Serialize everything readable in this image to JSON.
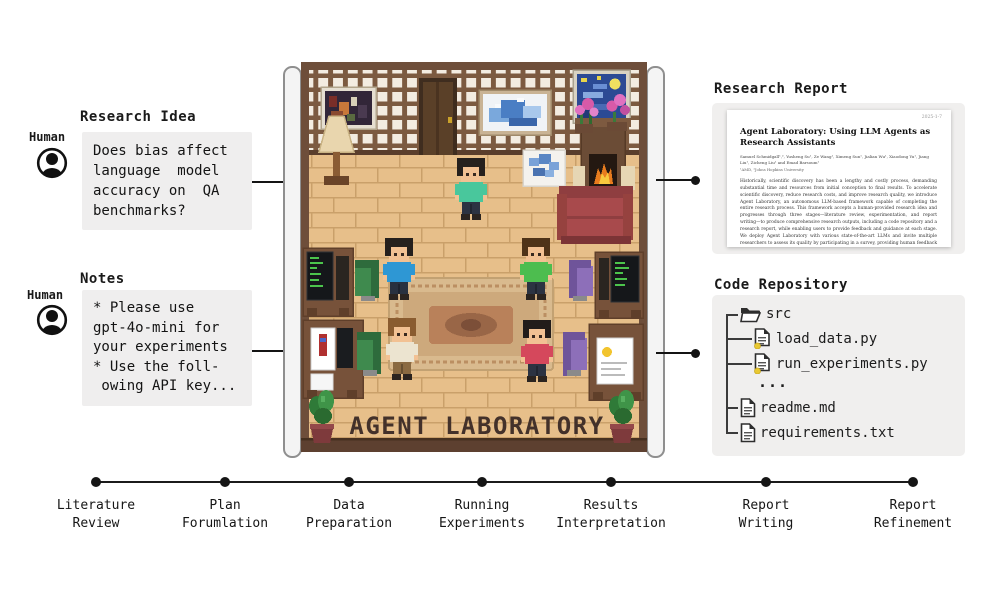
{
  "inputs": {
    "research_idea": {
      "heading": "Research Idea",
      "actor_label": "Human",
      "text": "Does bias affect\nlanguage  model\naccuracy on  QA\nbenchmarks?"
    },
    "notes": {
      "heading": "Notes",
      "actor_label": "Human",
      "text": "* Please use\ngpt-4o-mini for\nyour experiments\n* Use the foll-\n owing API key..."
    }
  },
  "lab": {
    "sign_text": "AGENT LABORATORY"
  },
  "outputs": {
    "research_report": {
      "heading": "Research Report",
      "paper": {
        "page_header": "2025-1-7",
        "title": "Agent Laboratory: Using LLM Agents as Research Assistants",
        "authors": "Samuel Schmidgall¹,², Yusheng Su¹, Ze Wang¹, Ximeng Sun¹, Jialian Wu¹, Xiaodong Yu¹, Jiang Liu¹, Zicheng Liu¹ and Emad Barsoum¹",
        "affiliation": "¹AMD, ²Johns Hopkins University",
        "abstract": "Historically, scientific discovery has been a lengthy and costly process, demanding substantial time and resources from initial conception to final results. To accelerate scientific discovery, reduce research costs, and improve research quality, we introduce Agent Laboratory, an autonomous LLM-based framework capable of completing the entire research process. This framework accepts a human-provided research idea and progresses through three stages—literature review, experimentation, and report writing—to produce comprehensive research outputs, including a code repository and a research report, while enabling users to provide feedback and guidance at each stage. We deploy Agent Laboratory with various state-of-the-art LLMs and invite multiple researchers to assess its quality by participating in a survey, providing human feedback to guide the research process, and then evaluate the final paper. We found that: (1) Agent Laboratory driven by o1-preview generates the"
      }
    },
    "code_repository": {
      "heading": "Code Repository",
      "tree": [
        {
          "type": "folder",
          "name": "src"
        },
        {
          "type": "pyfile",
          "name": "load_data.py"
        },
        {
          "type": "pyfile",
          "name": "run_experiments.py"
        },
        {
          "type": "ellipsis",
          "name": "..."
        },
        {
          "type": "file",
          "name": "readme.md"
        },
        {
          "type": "file",
          "name": "requirements.txt"
        }
      ]
    }
  },
  "timeline": {
    "stages": [
      {
        "top": "Literature",
        "bottom": "Review"
      },
      {
        "top": "Plan",
        "bottom": "Forumlation"
      },
      {
        "top": "Data",
        "bottom": "Preparation"
      },
      {
        "top": "Running",
        "bottom": "Experiments"
      },
      {
        "top": "Results",
        "bottom": "Interpretation"
      },
      {
        "top": "Report",
        "bottom": "Writing"
      },
      {
        "top": "Report",
        "bottom": "Refinement"
      }
    ]
  },
  "icons": {
    "human": "person-silhouette-in-circle",
    "folder": "open-folder",
    "pyfile": "document-with-yellow-dot",
    "file": "document"
  },
  "colors": {
    "panel_gray": "#f0efee",
    "box_gray": "#efeeee",
    "line_black": "#141414",
    "wood_frame": "#6e4e3a",
    "floor_tan": "#e7bf8a",
    "couch_red": "#a84a4c",
    "chair_green": "#3f8a4e",
    "chair_purple": "#8d6fb9",
    "shirt_teal": "#49c79c",
    "shirt_blue": "#2e97d4",
    "shirt_green": "#4dbd4f",
    "shirt_red": "#d5485c"
  }
}
